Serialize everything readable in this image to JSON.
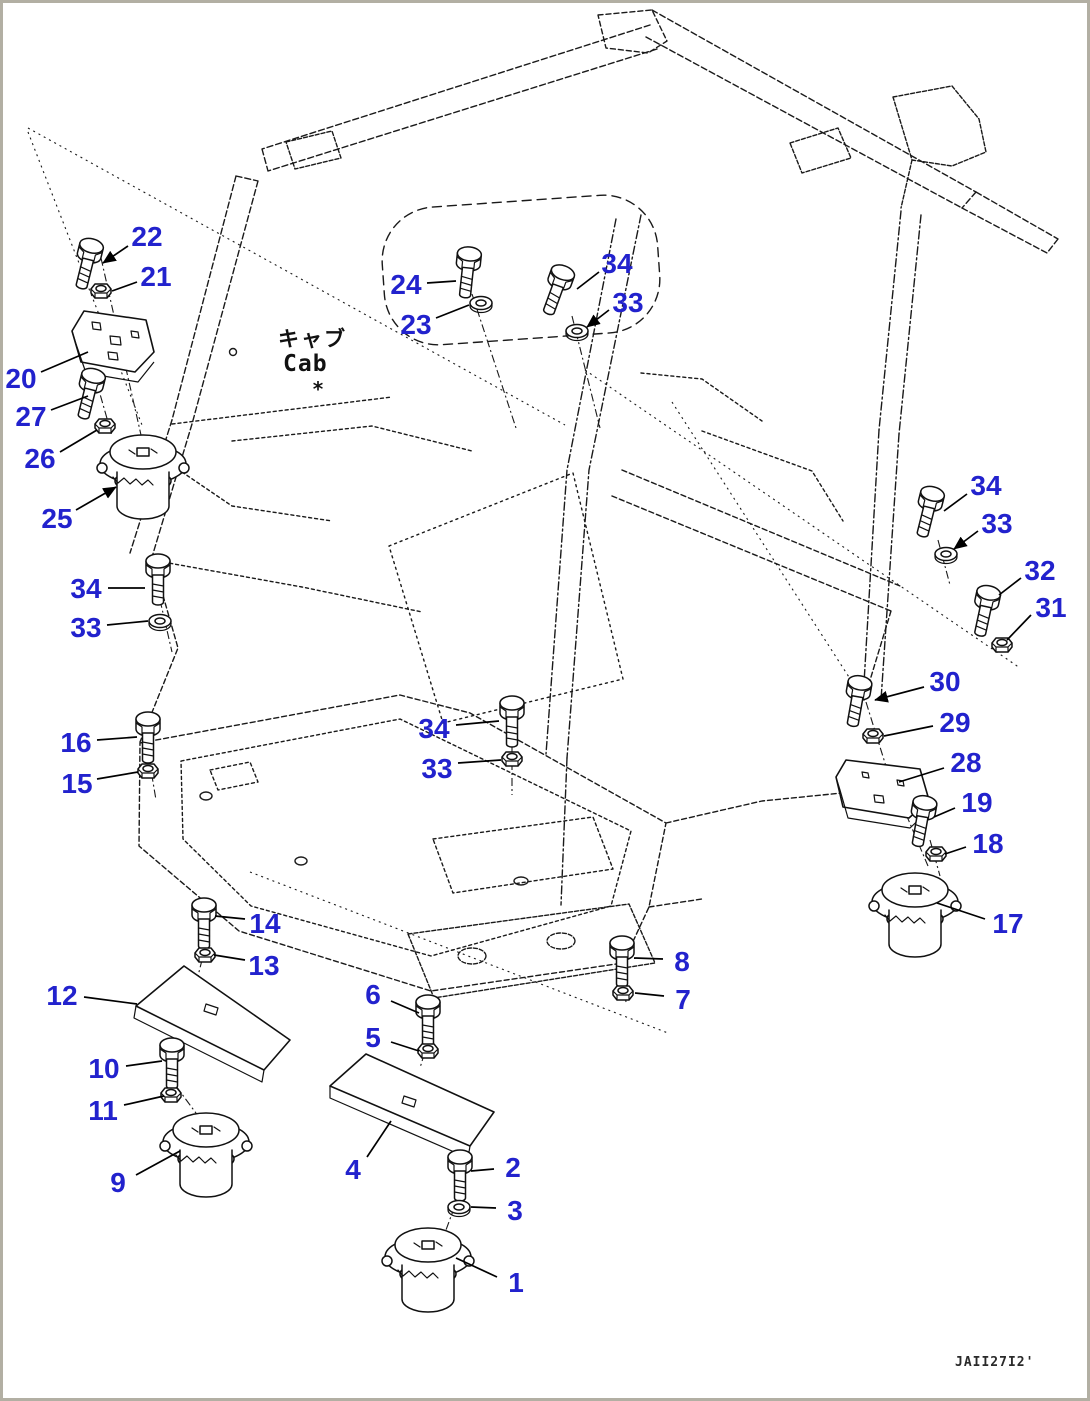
{
  "diagram": {
    "cab_label_jp": "キャブ",
    "cab_label_en": "Cab",
    "asterisk": "*",
    "drawing_number": "JAII27I2'",
    "colors": {
      "callout": "#2222cd",
      "line": "#1a1a1a",
      "border": "#b2afa3",
      "background": "#ffffff"
    }
  },
  "callouts": [
    {
      "id": "22",
      "label": "22",
      "lx": 147,
      "ly": 236,
      "x1": 128,
      "y1": 246,
      "x2": 103,
      "y2": 263,
      "arrow": true
    },
    {
      "id": "21",
      "label": "21",
      "lx": 156,
      "ly": 276,
      "x1": 137,
      "y1": 282,
      "x2": 112,
      "y2": 291,
      "arrow": false
    },
    {
      "id": "20",
      "label": "20",
      "lx": 21,
      "ly": 378,
      "x1": 41,
      "y1": 372,
      "x2": 88,
      "y2": 352,
      "arrow": false
    },
    {
      "id": "27",
      "label": "27",
      "lx": 31,
      "ly": 416,
      "x1": 51,
      "y1": 410,
      "x2": 88,
      "y2": 396,
      "arrow": false
    },
    {
      "id": "26",
      "label": "26",
      "lx": 40,
      "ly": 458,
      "x1": 60,
      "y1": 452,
      "x2": 97,
      "y2": 430,
      "arrow": false
    },
    {
      "id": "25",
      "label": "25",
      "lx": 57,
      "ly": 518,
      "x1": 76,
      "y1": 510,
      "x2": 116,
      "y2": 487,
      "arrow": true
    },
    {
      "id": "24",
      "label": "24",
      "lx": 406,
      "ly": 284,
      "x1": 427,
      "y1": 283,
      "x2": 456,
      "y2": 281,
      "arrow": false
    },
    {
      "id": "23",
      "label": "23",
      "lx": 416,
      "ly": 324,
      "x1": 436,
      "y1": 318,
      "x2": 469,
      "y2": 305,
      "arrow": false
    },
    {
      "id": "34-top",
      "label": "34",
      "lx": 617,
      "ly": 263,
      "x1": 599,
      "y1": 272,
      "x2": 577,
      "y2": 289,
      "arrow": false
    },
    {
      "id": "33-top",
      "label": "33",
      "lx": 628,
      "ly": 302,
      "x1": 609,
      "y1": 310,
      "x2": 587,
      "y2": 327,
      "arrow": true
    },
    {
      "id": "34-right",
      "label": "34",
      "lx": 986,
      "ly": 485,
      "x1": 967,
      "y1": 494,
      "x2": 944,
      "y2": 511,
      "arrow": false
    },
    {
      "id": "33-right",
      "label": "33",
      "lx": 997,
      "ly": 523,
      "x1": 978,
      "y1": 531,
      "x2": 954,
      "y2": 549,
      "arrow": true
    },
    {
      "id": "32",
      "label": "32",
      "lx": 1040,
      "ly": 570,
      "x1": 1021,
      "y1": 578,
      "x2": 999,
      "y2": 595,
      "arrow": false
    },
    {
      "id": "31",
      "label": "31",
      "lx": 1051,
      "ly": 607,
      "x1": 1031,
      "y1": 615,
      "x2": 1007,
      "y2": 640,
      "arrow": false
    },
    {
      "id": "30",
      "label": "30",
      "lx": 945,
      "ly": 681,
      "x1": 924,
      "y1": 687,
      "x2": 875,
      "y2": 700,
      "arrow": true
    },
    {
      "id": "29",
      "label": "29",
      "lx": 955,
      "ly": 722,
      "x1": 933,
      "y1": 726,
      "x2": 884,
      "y2": 736,
      "arrow": false
    },
    {
      "id": "28",
      "label": "28",
      "lx": 966,
      "ly": 762,
      "x1": 944,
      "y1": 768,
      "x2": 899,
      "y2": 782,
      "arrow": false
    },
    {
      "id": "19",
      "label": "19",
      "lx": 977,
      "ly": 802,
      "x1": 955,
      "y1": 808,
      "x2": 934,
      "y2": 817,
      "arrow": false
    },
    {
      "id": "18",
      "label": "18",
      "lx": 988,
      "ly": 843,
      "x1": 966,
      "y1": 847,
      "x2": 945,
      "y2": 854,
      "arrow": false
    },
    {
      "id": "17",
      "label": "17",
      "lx": 1008,
      "ly": 923,
      "x1": 985,
      "y1": 919,
      "x2": 937,
      "y2": 903,
      "arrow": false
    },
    {
      "id": "34-left",
      "label": "34",
      "lx": 86,
      "ly": 588,
      "x1": 108,
      "y1": 588,
      "x2": 145,
      "y2": 588,
      "arrow": false
    },
    {
      "id": "33-left",
      "label": "33",
      "lx": 86,
      "ly": 627,
      "x1": 107,
      "y1": 625,
      "x2": 148,
      "y2": 621,
      "arrow": false
    },
    {
      "id": "16",
      "label": "16",
      "lx": 76,
      "ly": 742,
      "x1": 97,
      "y1": 740,
      "x2": 137,
      "y2": 737,
      "arrow": false
    },
    {
      "id": "15",
      "label": "15",
      "lx": 77,
      "ly": 783,
      "x1": 97,
      "y1": 779,
      "x2": 138,
      "y2": 772,
      "arrow": false
    },
    {
      "id": "34-mid",
      "label": "34",
      "lx": 434,
      "ly": 728,
      "x1": 456,
      "y1": 725,
      "x2": 499,
      "y2": 721,
      "arrow": false
    },
    {
      "id": "33-mid",
      "label": "33",
      "lx": 437,
      "ly": 768,
      "x1": 458,
      "y1": 763,
      "x2": 501,
      "y2": 760,
      "arrow": false
    },
    {
      "id": "14",
      "label": "14",
      "lx": 265,
      "ly": 923,
      "x1": 245,
      "y1": 919,
      "x2": 215,
      "y2": 916,
      "arrow": false
    },
    {
      "id": "13",
      "label": "13",
      "lx": 264,
      "ly": 965,
      "x1": 245,
      "y1": 960,
      "x2": 214,
      "y2": 955,
      "arrow": false
    },
    {
      "id": "12",
      "label": "12",
      "lx": 62,
      "ly": 995,
      "x1": 84,
      "y1": 997,
      "x2": 137,
      "y2": 1004,
      "arrow": false
    },
    {
      "id": "10",
      "label": "10",
      "lx": 104,
      "ly": 1068,
      "x1": 126,
      "y1": 1066,
      "x2": 162,
      "y2": 1061,
      "arrow": false
    },
    {
      "id": "11",
      "label": "11",
      "lx": 103,
      "ly": 1110,
      "x1": 124,
      "y1": 1105,
      "x2": 164,
      "y2": 1096,
      "arrow": false
    },
    {
      "id": "9",
      "label": "9",
      "lx": 118,
      "ly": 1182,
      "x1": 136,
      "y1": 1175,
      "x2": 180,
      "y2": 1151,
      "arrow": false
    },
    {
      "id": "8",
      "label": "8",
      "lx": 682,
      "ly": 961,
      "x1": 663,
      "y1": 959,
      "x2": 634,
      "y2": 958,
      "arrow": false
    },
    {
      "id": "7",
      "label": "7",
      "lx": 683,
      "ly": 999,
      "x1": 664,
      "y1": 996,
      "x2": 635,
      "y2": 993,
      "arrow": false
    },
    {
      "id": "6",
      "label": "6",
      "lx": 373,
      "ly": 994,
      "x1": 391,
      "y1": 1001,
      "x2": 419,
      "y2": 1013,
      "arrow": false
    },
    {
      "id": "5",
      "label": "5",
      "lx": 373,
      "ly": 1037,
      "x1": 391,
      "y1": 1042,
      "x2": 419,
      "y2": 1051,
      "arrow": false
    },
    {
      "id": "4",
      "label": "4",
      "lx": 353,
      "ly": 1169,
      "x1": 367,
      "y1": 1157,
      "x2": 391,
      "y2": 1121,
      "arrow": false
    },
    {
      "id": "2",
      "label": "2",
      "lx": 513,
      "ly": 1167,
      "x1": 494,
      "y1": 1169,
      "x2": 471,
      "y2": 1171,
      "arrow": false
    },
    {
      "id": "3",
      "label": "3",
      "lx": 515,
      "ly": 1210,
      "x1": 496,
      "y1": 1208,
      "x2": 471,
      "y2": 1207,
      "arrow": false
    },
    {
      "id": "1",
      "label": "1",
      "lx": 516,
      "ly": 1282,
      "x1": 497,
      "y1": 1277,
      "x2": 456,
      "y2": 1258,
      "arrow": false
    }
  ],
  "parts": [
    {
      "type": "bolt",
      "id": "22",
      "x": 93,
      "y": 240,
      "rot": 14
    },
    {
      "type": "bolt",
      "id": "27",
      "x": 95,
      "y": 370,
      "rot": 14
    },
    {
      "type": "bolt",
      "id": "24",
      "x": 470,
      "y": 248,
      "rot": 6
    },
    {
      "type": "bolt",
      "id": "34-top",
      "x": 565,
      "y": 267,
      "rot": 20
    },
    {
      "type": "bolt",
      "id": "34-left",
      "x": 158,
      "y": 555,
      "rot": 0
    },
    {
      "type": "bolt",
      "id": "16",
      "x": 148,
      "y": 713,
      "rot": 0
    },
    {
      "type": "bolt",
      "id": "34-mid",
      "x": 512,
      "y": 697,
      "rot": 0
    },
    {
      "type": "bolt",
      "id": "34-right",
      "x": 934,
      "y": 488,
      "rot": 14
    },
    {
      "type": "bolt",
      "id": "32",
      "x": 990,
      "y": 587,
      "rot": 12
    },
    {
      "type": "bolt",
      "id": "30",
      "x": 861,
      "y": 677,
      "rot": 10
    },
    {
      "type": "bolt",
      "id": "19",
      "x": 926,
      "y": 797,
      "rot": 10
    },
    {
      "type": "bolt",
      "id": "14",
      "x": 204,
      "y": 899,
      "rot": 0
    },
    {
      "type": "bolt",
      "id": "10",
      "x": 172,
      "y": 1039,
      "rot": 0
    },
    {
      "type": "bolt",
      "id": "8",
      "x": 622,
      "y": 937,
      "rot": 0
    },
    {
      "type": "bolt",
      "id": "6",
      "x": 428,
      "y": 996,
      "rot": 0
    },
    {
      "type": "bolt",
      "id": "2",
      "x": 460,
      "y": 1151,
      "rot": 0
    },
    {
      "type": "nut",
      "id": "21",
      "x": 101,
      "y": 291,
      "rot": 0
    },
    {
      "type": "nut",
      "id": "26",
      "x": 105,
      "y": 426,
      "rot": 0
    },
    {
      "type": "nut",
      "id": "15",
      "x": 148,
      "y": 771,
      "rot": 0
    },
    {
      "type": "nut",
      "id": "33-mid",
      "x": 512,
      "y": 759,
      "rot": 0
    },
    {
      "type": "nut",
      "id": "13",
      "x": 205,
      "y": 955,
      "rot": 0
    },
    {
      "type": "nut",
      "id": "11",
      "x": 171,
      "y": 1095,
      "rot": 0
    },
    {
      "type": "nut",
      "id": "7",
      "x": 623,
      "y": 993,
      "rot": 0
    },
    {
      "type": "nut",
      "id": "5",
      "x": 428,
      "y": 1051,
      "rot": 0
    },
    {
      "type": "nut",
      "id": "29",
      "x": 873,
      "y": 736,
      "rot": 0
    },
    {
      "type": "nut",
      "id": "31",
      "x": 1002,
      "y": 645,
      "rot": 0
    },
    {
      "type": "nut",
      "id": "18",
      "x": 936,
      "y": 854,
      "rot": 0
    },
    {
      "type": "washer",
      "id": "23",
      "x": 481,
      "y": 303,
      "rot": 0
    },
    {
      "type": "washer",
      "id": "33-top",
      "x": 577,
      "y": 331,
      "rot": 0
    },
    {
      "type": "washer",
      "id": "33-left",
      "x": 160,
      "y": 621,
      "rot": 0
    },
    {
      "type": "washer",
      "id": "33-right",
      "x": 946,
      "y": 554,
      "rot": 0
    },
    {
      "type": "washer",
      "id": "3",
      "x": 459,
      "y": 1207,
      "rot": 0
    },
    {
      "type": "mount",
      "id": "25",
      "x": 143,
      "y": 452,
      "rot": 0
    },
    {
      "type": "mount",
      "id": "17",
      "x": 915,
      "y": 890,
      "rot": 0
    },
    {
      "type": "mount",
      "id": "9",
      "x": 206,
      "y": 1130,
      "rot": 0
    },
    {
      "type": "mount",
      "id": "1",
      "x": 428,
      "y": 1245,
      "rot": 0
    }
  ]
}
